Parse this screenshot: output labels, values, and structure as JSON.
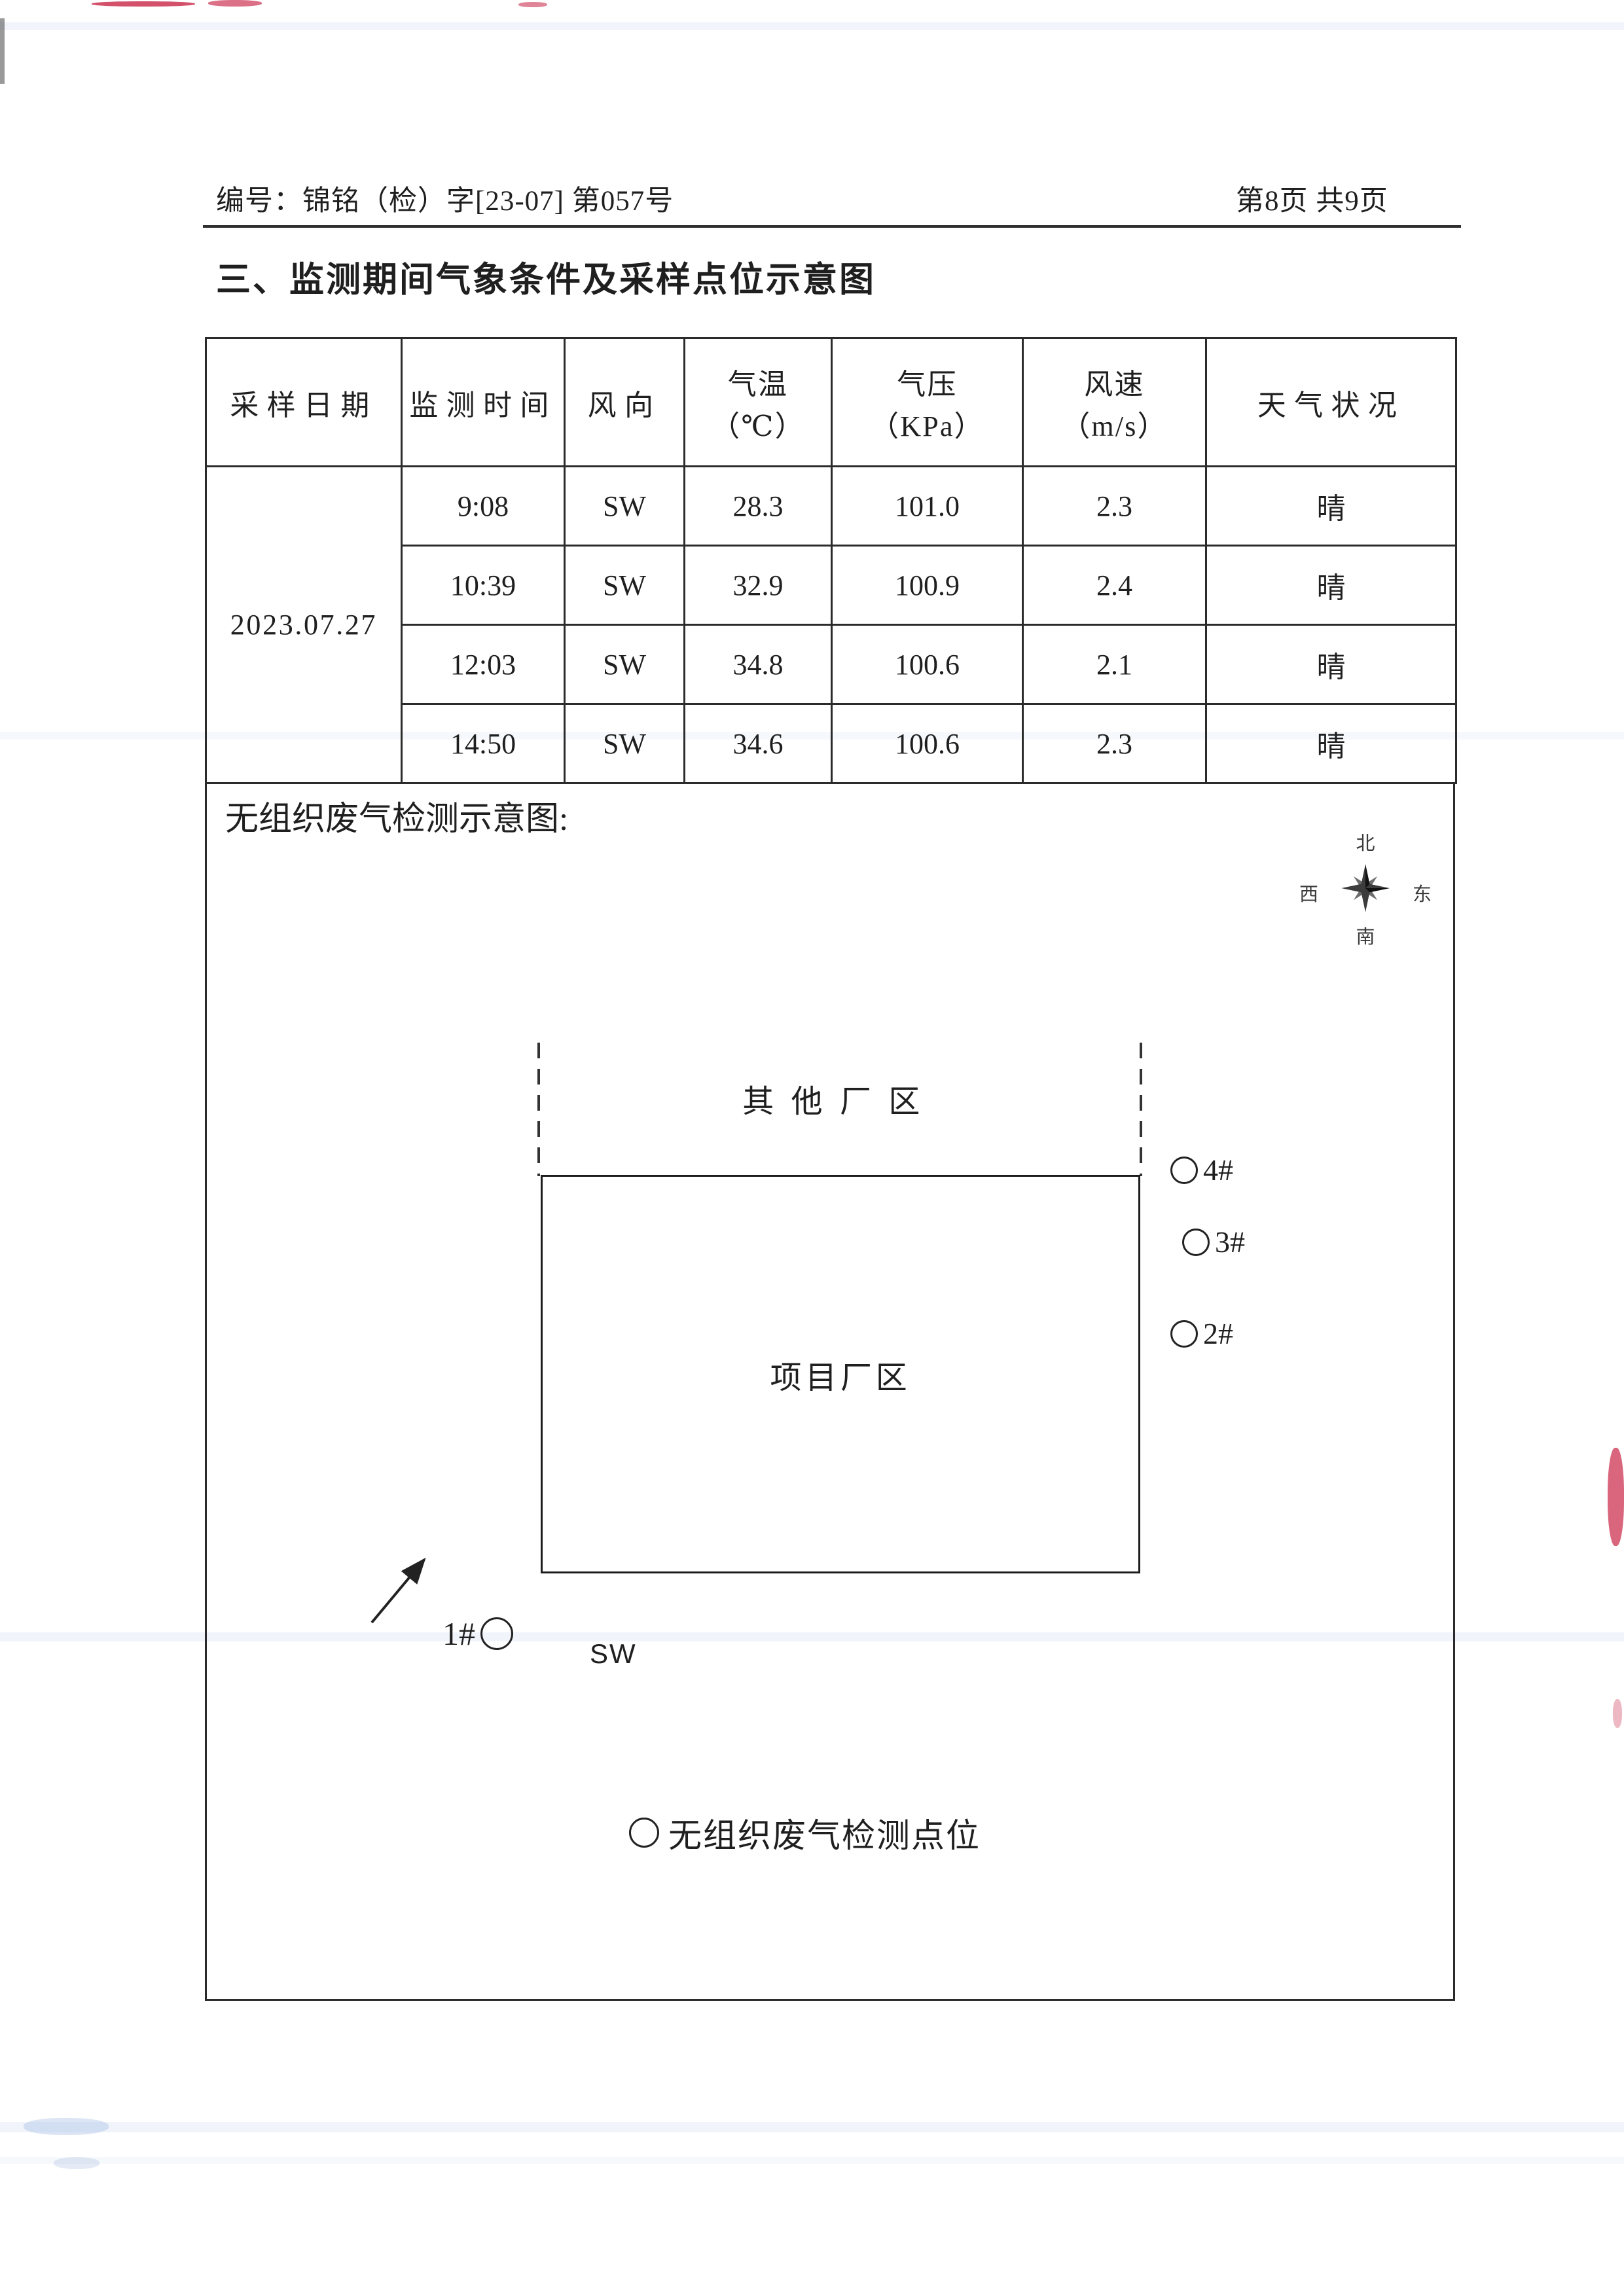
{
  "page": {
    "header_left": "编号：锦铭（检）字[23-07] 第057号",
    "header_right": "第8页 共9页",
    "section_title": "三、监测期间气象条件及采样点位示意图"
  },
  "weather_table": {
    "columns": [
      "采样日期",
      "监测时间",
      "风向",
      "气温\n（℃）",
      "气压\n（KPa）",
      "风速\n（m/s）",
      "天气状况"
    ],
    "date": "2023.07.27",
    "rows": [
      {
        "time": "9:08",
        "wind": "SW",
        "temp": "28.3",
        "pressure": "101.0",
        "speed": "2.3",
        "weather": "晴"
      },
      {
        "time": "10:39",
        "wind": "SW",
        "temp": "32.9",
        "pressure": "100.9",
        "speed": "2.4",
        "weather": "晴"
      },
      {
        "time": "12:03",
        "wind": "SW",
        "temp": "34.8",
        "pressure": "100.6",
        "speed": "2.1",
        "weather": "晴"
      },
      {
        "time": "14:50",
        "wind": "SW",
        "temp": "34.6",
        "pressure": "100.6",
        "speed": "2.3",
        "weather": "晴"
      }
    ]
  },
  "diagram": {
    "label": "无组织废气检测示意图:",
    "compass": {
      "north": "北",
      "south": "南",
      "west": "西",
      "east": "东"
    },
    "other_area_label": "其他厂区",
    "project_area_label": "项目厂区",
    "points": {
      "p1": "1#",
      "p2": "2#",
      "p3": "3#",
      "p4": "4#"
    },
    "wind_direction_label": "SW",
    "legend_label": "无组织废气检测点位"
  },
  "colors": {
    "ink": "#1f1f1f",
    "artifact_red": "#cc3352",
    "artifact_blue": "#82a0d7"
  }
}
